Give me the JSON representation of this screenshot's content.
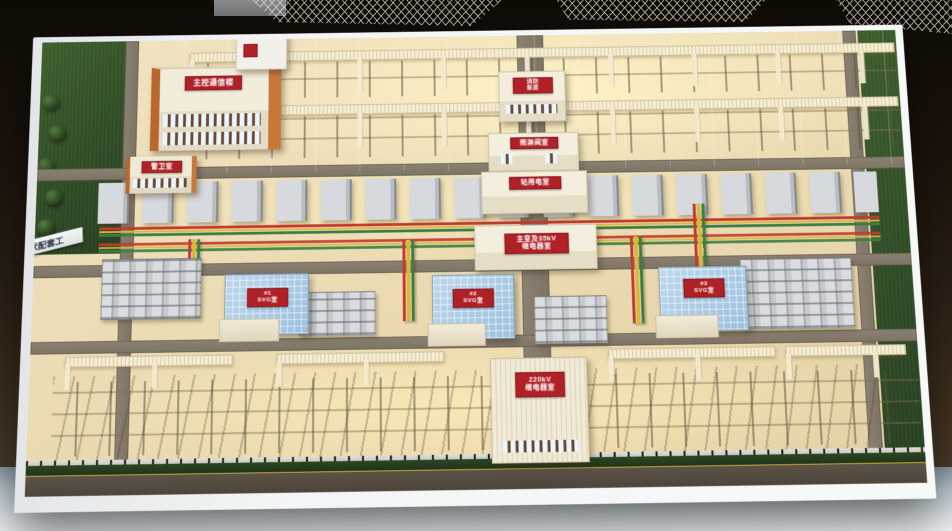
{
  "scene": {
    "subject": "变电站沙盘模型 (physical scale model of a 220kV substation on an exhibition table)",
    "colors": {
      "sign_red": "#b02027",
      "busbar_red": "#c23a30",
      "busbar_yellow": "#d9b83c",
      "busbar_green": "#3d7d45",
      "roof_blue": "#a9c8e2",
      "ground_warm": "#ecdcb4",
      "lattice_cream": "#f3ead0",
      "turf_green": "#33502a",
      "road_gray": "#7e7466",
      "base_white": "#f4f5f6",
      "road_marking_yellow": "#c9a63f"
    }
  },
  "plaque": {
    "text": "伏配套工"
  },
  "buildings": {
    "main_control": {
      "label": "主控通信楼"
    },
    "guard": {
      "label": "警卫室"
    },
    "fire_pump": {
      "l1": "消防",
      "l2": "泵房"
    },
    "deluge": {
      "label": "雨淋阀室"
    },
    "station_power": {
      "label": "站用电室"
    },
    "relay35": {
      "l1": "主变及35kV",
      "l2": "继电器室"
    },
    "svg1": {
      "l1": "#1",
      "l2": "SVG室"
    },
    "svg2": {
      "l1": "#2",
      "l2": "SVG室"
    },
    "svg3": {
      "l1": "#3",
      "l2": "SVG室"
    },
    "relay220": {
      "l1": "220kV",
      "l2": "继电器室"
    }
  }
}
